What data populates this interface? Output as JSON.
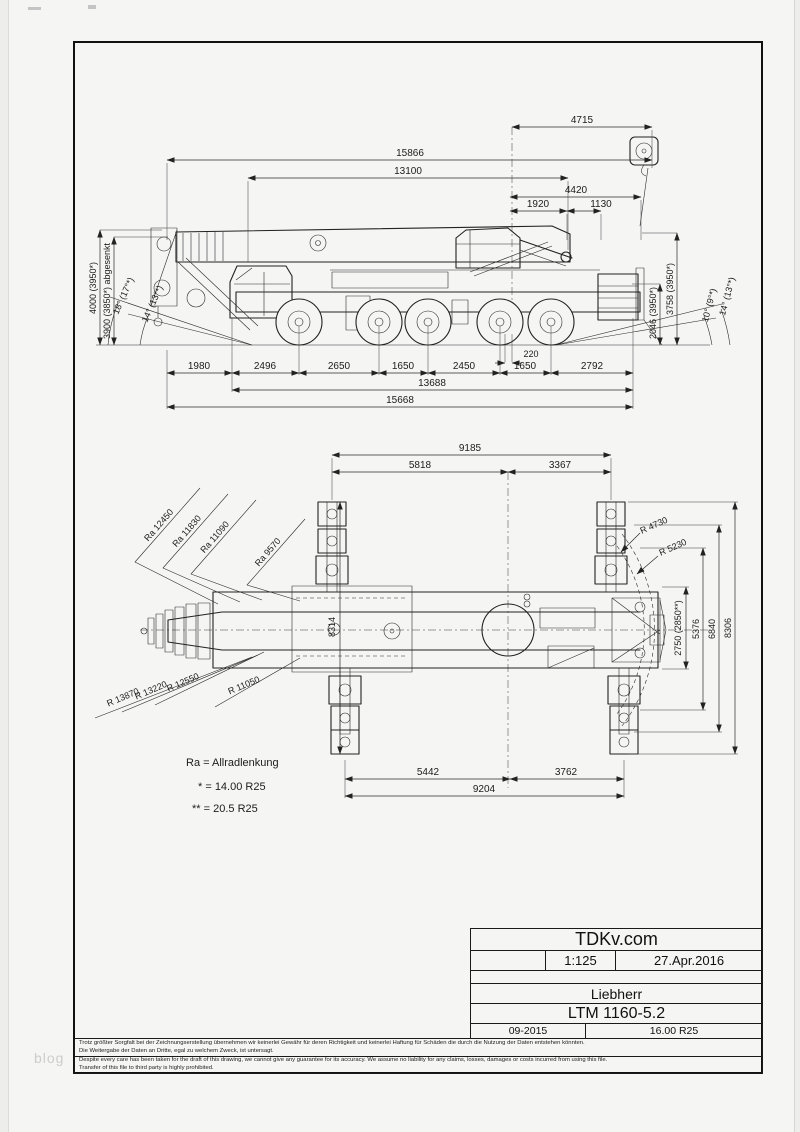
{
  "watermark": "blog",
  "side": {
    "top_dims": [
      "4715",
      "15866",
      "13100",
      "4420",
      "1920",
      "1130"
    ],
    "left_heights": [
      "4000 (3950*)",
      "3900 (3850*) abgesenkt"
    ],
    "left_angles": [
      "18° (17°*)",
      "14° (13°*)"
    ],
    "right_heights": [
      "3758 (3950*)",
      "2046 (3950*)"
    ],
    "right_angles": [
      "14° (13°*)",
      "10° (9°*)"
    ],
    "axle_dims": [
      "1980",
      "2496",
      "2650",
      "1650",
      "2450",
      "1650",
      "2792"
    ],
    "gap_dim": "220",
    "wheelbase_total": "13688",
    "overall_length": "15668"
  },
  "plan": {
    "top_dims": [
      "9185",
      "5818",
      "3367"
    ],
    "bottom_dims": [
      "5442",
      "3762",
      "9204"
    ],
    "right_dims": [
      "2750 (2850**)",
      "5376",
      "6840",
      "8306"
    ],
    "support_spread": "8314",
    "steering_radii": [
      "Ra 12450",
      "Ra 11830",
      "Ra 11090",
      "Ra 9570"
    ],
    "turning_radii": [
      "R 13870",
      "R 13220",
      "R 12550",
      "R 11050"
    ],
    "tail_radii": [
      "R 4730",
      "R 5230"
    ]
  },
  "legend": {
    "allrad": "Ra = Allradlenkung",
    "tire_note_1": "* = 14.00 R25",
    "tire_note_2": "** = 20.5 R25"
  },
  "title_block": {
    "site": "TDKv.com",
    "scale": "1:125",
    "date": "27.Apr.2016",
    "maker": "Liebherr",
    "model": "LTM 1160-5.2",
    "doc_date": "09-2015",
    "tires": "16.00 R25"
  },
  "disclaimer": {
    "de_1": "Trotz größter Sorgfalt bei der Zeichnungserstellung übernehmen wir keinerlei Gewähr für deren Richtigkeit und keinerlei Haftung für Schäden die durch die Nutzung der Daten entstehen könnten.",
    "de_2": "Die Weitergabe der Daten an Dritte, egal zu welchem Zweck, ist untersagt.",
    "en_1": "Despite every care has been taken for the draft of this drawing, we cannot give any guarantee for its accuracy. We assume no liability for any claims, losses, damages or costs incurred from using this file.",
    "en_2": "Transfer of this file to third party is highly prohibited."
  }
}
